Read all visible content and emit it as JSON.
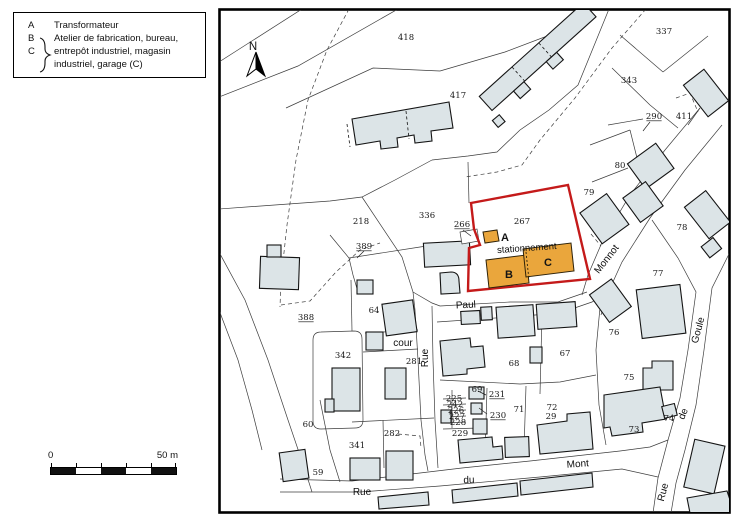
{
  "legend": {
    "items": [
      {
        "key": "A",
        "text": "Transformateur"
      },
      {
        "key": "B",
        "text": "Atelier de fabrication, bureau,"
      },
      {
        "key": "C",
        "text": "entrepôt industriel, magasin"
      },
      {
        "key": "",
        "text": "industriel, garage (C)"
      }
    ]
  },
  "scale_bar": {
    "start_label": "0",
    "end_label": "50 m"
  },
  "colors": {
    "bfill": "#dce4e7",
    "bstroke": "#141414",
    "line": "#3d3d3d",
    "red": "#c41a1a",
    "orange": "#eaa63c",
    "frame": "#000000"
  },
  "map": {
    "labels": [
      {
        "t": "n",
        "text": "N",
        "x": 253,
        "y": 50
      },
      {
        "t": "p",
        "text": "418",
        "x": 406,
        "y": 40
      },
      {
        "t": "p",
        "text": "417",
        "x": 458,
        "y": 98
      },
      {
        "t": "p",
        "text": "337",
        "x": 664,
        "y": 34
      },
      {
        "t": "p",
        "text": "343",
        "x": 629,
        "y": 83
      },
      {
        "t": "p",
        "text": "290",
        "x": 654,
        "y": 119,
        "u": 1
      },
      {
        "t": "p",
        "text": "411",
        "x": 684,
        "y": 119
      },
      {
        "t": "p",
        "text": "80",
        "x": 620,
        "y": 168
      },
      {
        "t": "p",
        "text": "79",
        "x": 589,
        "y": 195
      },
      {
        "t": "p",
        "text": "78",
        "x": 682,
        "y": 230
      },
      {
        "t": "p",
        "text": "77",
        "x": 658,
        "y": 276
      },
      {
        "t": "p",
        "text": "76",
        "x": 614,
        "y": 335
      },
      {
        "t": "p",
        "text": "75",
        "x": 629,
        "y": 380
      },
      {
        "t": "p",
        "text": "74",
        "x": 669,
        "y": 421,
        "size": 7
      },
      {
        "t": "p",
        "text": "73",
        "x": 634,
        "y": 432
      },
      {
        "t": "p",
        "text": "72",
        "x": 552,
        "y": 410
      },
      {
        "t": "p",
        "text": "29",
        "x": 551,
        "y": 419,
        "size": 4.5
      },
      {
        "t": "p",
        "text": "71",
        "x": 519,
        "y": 412
      },
      {
        "t": "p",
        "text": "67",
        "x": 565,
        "y": 356
      },
      {
        "t": "p",
        "text": "68",
        "x": 514,
        "y": 366
      },
      {
        "t": "p",
        "text": "69",
        "x": 477,
        "y": 392
      },
      {
        "t": "p",
        "text": "229",
        "x": 460,
        "y": 436
      },
      {
        "t": "p",
        "text": "225",
        "x": 454,
        "y": 401,
        "size": 5.5
      },
      {
        "t": "p",
        "text": "242",
        "x": 455,
        "y": 407,
        "size": 5.5
      },
      {
        "t": "p",
        "text": "226",
        "x": 456,
        "y": 413,
        "size": 5.5
      },
      {
        "t": "p",
        "text": "227",
        "x": 457,
        "y": 419,
        "size": 5.5
      },
      {
        "t": "p",
        "text": "228",
        "x": 458,
        "y": 425,
        "size": 5.5
      },
      {
        "t": "p",
        "text": "230",
        "x": 498,
        "y": 418,
        "u": 1
      },
      {
        "t": "p",
        "text": "231",
        "x": 497,
        "y": 397,
        "u": 1
      },
      {
        "t": "p",
        "text": "218",
        "x": 361,
        "y": 224
      },
      {
        "t": "p",
        "text": "336",
        "x": 427,
        "y": 218
      },
      {
        "t": "p",
        "text": "266",
        "x": 462,
        "y": 227,
        "u": 1
      },
      {
        "t": "p",
        "text": "267",
        "x": 522,
        "y": 224
      },
      {
        "t": "p",
        "text": "389",
        "x": 364,
        "y": 249,
        "u": 1
      },
      {
        "t": "p",
        "text": "388",
        "x": 306,
        "y": 320,
        "u": 1
      },
      {
        "t": "p",
        "text": "64",
        "x": 374,
        "y": 313
      },
      {
        "t": "p",
        "text": "342",
        "x": 343,
        "y": 358
      },
      {
        "t": "p",
        "text": "281",
        "x": 414,
        "y": 364
      },
      {
        "t": "p",
        "text": "282",
        "x": 392,
        "y": 436
      },
      {
        "t": "p",
        "text": "341",
        "x": 357,
        "y": 448
      },
      {
        "t": "p",
        "text": "60",
        "x": 308,
        "y": 427
      },
      {
        "t": "p",
        "text": "59",
        "x": 318,
        "y": 475
      },
      {
        "t": "s",
        "text": "Paul",
        "x": 466,
        "y": 308,
        "rot": -3
      },
      {
        "t": "s",
        "text": "Monnot",
        "x": 609,
        "y": 261,
        "rot": -52
      },
      {
        "t": "s",
        "text": "Goule",
        "x": 701,
        "y": 331,
        "rot": -75
      },
      {
        "t": "s",
        "text": "de",
        "x": 686,
        "y": 415,
        "rot": -68
      },
      {
        "t": "s",
        "text": "Rue",
        "x": 666,
        "y": 493,
        "rot": -75
      },
      {
        "t": "s",
        "text": "Mont",
        "x": 578,
        "y": 467,
        "rot": -4
      },
      {
        "t": "s",
        "text": "du",
        "x": 469,
        "y": 483,
        "rot": -2
      },
      {
        "t": "s",
        "text": "Rue",
        "x": 362,
        "y": 495
      },
      {
        "t": "s",
        "text": "Rue",
        "x": 428,
        "y": 358,
        "rot": -90
      },
      {
        "t": "s",
        "text": "cour",
        "x": 403,
        "y": 346,
        "size": 9
      },
      {
        "t": "m",
        "text": "A",
        "x": 505,
        "y": 241
      },
      {
        "t": "m",
        "text": "B",
        "x": 509,
        "y": 278
      },
      {
        "t": "m",
        "text": "C",
        "x": 548,
        "y": 266
      },
      {
        "t": "note",
        "text": "stationnement",
        "x": 527,
        "y": 251,
        "rot": -4
      }
    ]
  }
}
